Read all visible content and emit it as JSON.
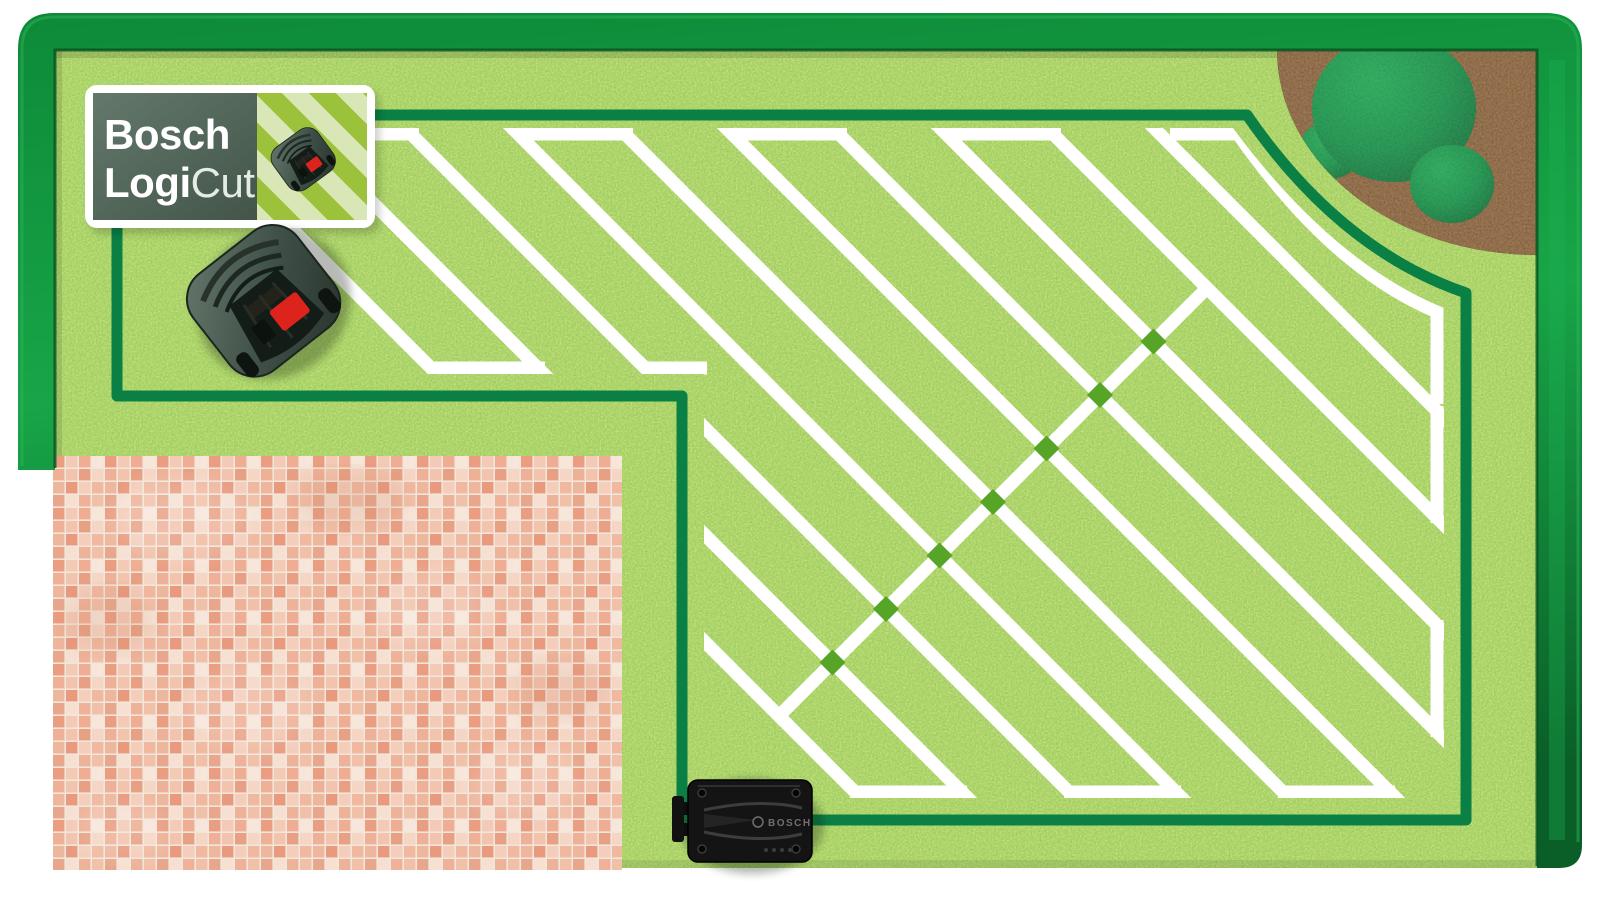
{
  "badge": {
    "brand_line1": "Bosch",
    "brand_line2_bold": "Logi",
    "brand_line2_light": "Cut"
  },
  "charging_station": {
    "label": "BOSCH"
  },
  "colors": {
    "lawn_green": "#57a527",
    "lawn_speckle_light": "#a8d95b",
    "lawn_speckle_dark": "#3e8a1c",
    "boundary_wire": "#0a8045",
    "mowed_line": "#ffffff",
    "hedge_dark": "#0a6328",
    "hedge_bright": "#17a144",
    "soil_brown": "#4a2e1d",
    "bush_green": "#12813c",
    "patio_tile": "#efb29a",
    "patio_grout": "#f2e5da",
    "badge_panel": "#556a5e",
    "badge_stripe_base": "#9cc23b",
    "badge_stripe_light": "#d9e6b5",
    "mower_body": "#3c4b42",
    "mower_button_red": "#da251d",
    "station_black": "#141414"
  },
  "patio_palette": [
    "#eeb096",
    "#f2c3ad",
    "#e8a084",
    "#f5d6c4",
    "#edb79e",
    "#e99a7e",
    "#f4cdbb",
    "#f0b99f",
    "#e8a78c",
    "#f6e0d2",
    "#eeb298",
    "#f1c0a8",
    "#ea9d80",
    "#f3cab6",
    "#efae93",
    "#f7e6da"
  ],
  "scene": {
    "boundary_wire_path": "M117,115 H1247 Q1340,250 1466,293 V820 H682 V396 H117 Z",
    "mow_clip_path": "M139,128 H1233 Q1332,262 1444,308 V798 H704 V374 H139 Z",
    "lane_top_xs": [
      200,
      307,
      414,
      521,
      628,
      735,
      842,
      949,
      1056,
      1163
    ],
    "lane_width": 13,
    "connectors": {
      "top_y": 134,
      "top_pairs": [
        [
          307,
          414
        ],
        [
          521,
          628
        ],
        [
          735,
          842
        ],
        [
          949,
          1056
        ]
      ],
      "notch_y": 368,
      "notch_pairs": [
        [
          433,
          540
        ],
        [
          651,
          702
        ]
      ],
      "bottom_y": 792,
      "bottom_pairs": [
        [
          855,
          962
        ],
        [
          1069,
          1176
        ],
        [
          1283,
          1390
        ]
      ],
      "right_x": 1437,
      "right_pairs": [
        [
          411,
          518
        ],
        [
          625,
          732
        ]
      ],
      "arc_path": "M1170,134 H1238 Q1332,268 1437,312 V404"
    },
    "seam_points": [
      [
        779,
        716
      ],
      [
        832.5,
        662.5
      ],
      [
        886,
        609
      ],
      [
        939.5,
        555.5
      ],
      [
        993,
        502
      ],
      [
        1046.5,
        448.5
      ],
      [
        1100,
        395
      ],
      [
        1153.5,
        341.5
      ],
      [
        1207,
        288
      ]
    ],
    "diamond_half": 13
  }
}
